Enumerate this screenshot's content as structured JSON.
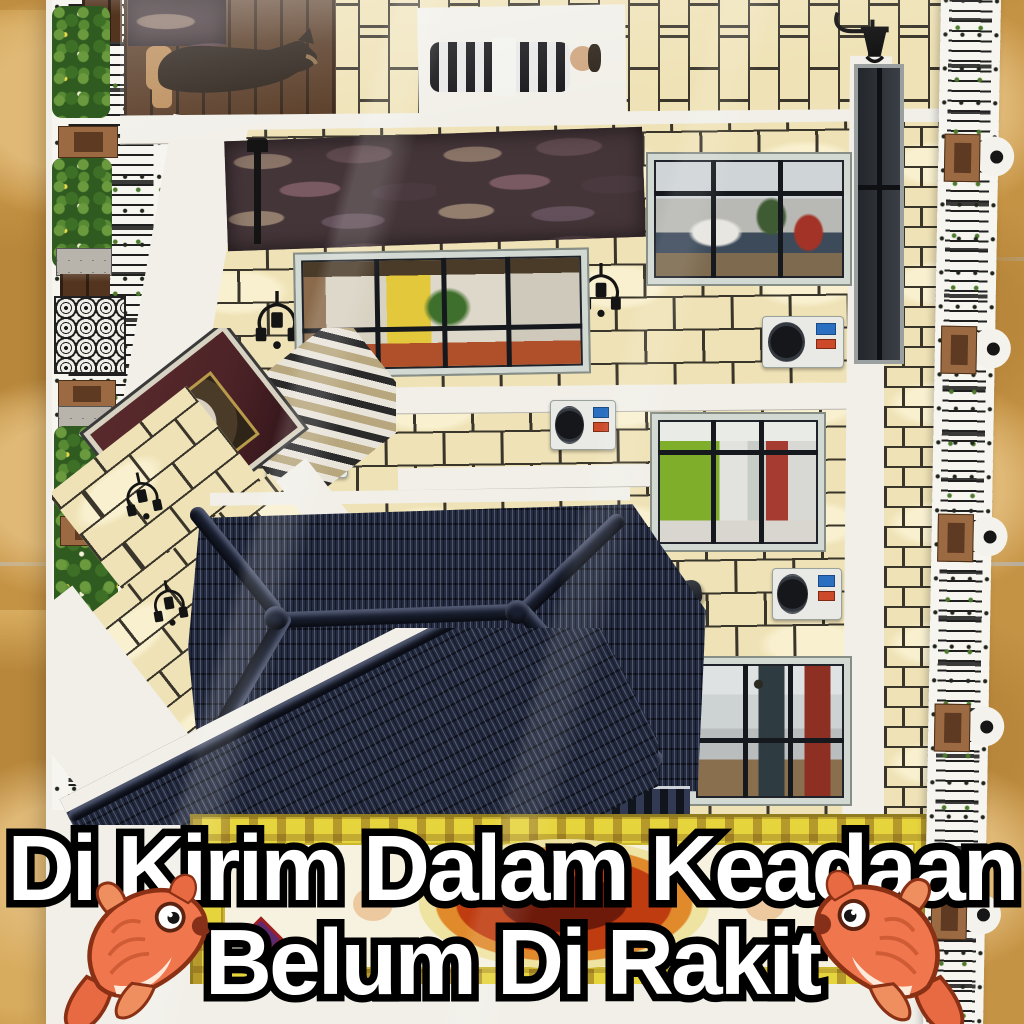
{
  "caption": {
    "line1": "Di Kirim Dalam Keadaan",
    "line2": "Belum Di Rakit"
  },
  "icons": {
    "bottom_left": "koi-fish",
    "bottom_right": "koi-fish"
  },
  "colors": {
    "floor_tan": "#c59344",
    "floor_grout": "#b5ada0",
    "sheet_white": "#f1efe8",
    "brick_cream": "#efe2b6",
    "brick_line": "#3a352a",
    "roof_navy": "#242b40",
    "roof_ridge": "#1b2132",
    "stone_dark": "#443539",
    "wood_brown": "#53351f",
    "maroon_panel": "#4c2327",
    "fence_black": "#1f1f1f",
    "post_brown": "#9b6a42",
    "leaf_green": "#4c7a2c",
    "carpet_yellow": "#e6d43d",
    "carpet_red": "#bf3c10",
    "ac_white": "#e9eae5",
    "caption_fill": "#ffffff",
    "caption_outline": "#000000",
    "koi_orange": "#f0764e"
  }
}
